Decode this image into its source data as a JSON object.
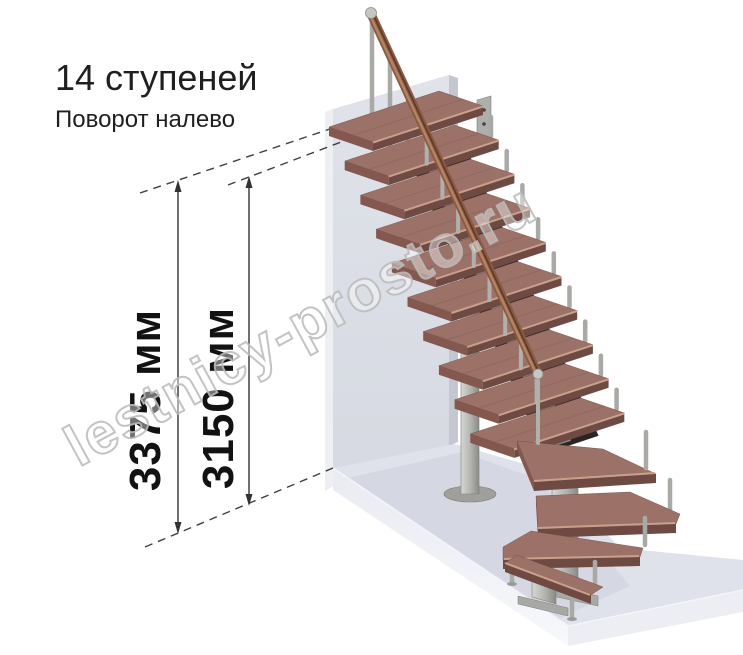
{
  "header": {
    "title": "14 ступеней",
    "subtitle": "Поворот налево"
  },
  "dimensions": {
    "outer": {
      "label": "3375 мм"
    },
    "inner": {
      "label": "3150 мм"
    }
  },
  "watermark": {
    "text": "lestnicy-prosto.ru"
  },
  "staircase": {
    "steps_count": "14",
    "turn_direction": "налево",
    "straight_treads": 10,
    "winder_treads": 3,
    "bottom_treads": 1
  },
  "colors": {
    "text": "#1f1f1f",
    "wood_top": "#9c7167",
    "wood_front": "#6e4a43",
    "metal": "#b3b4b0",
    "wall": "#dcdfe7",
    "floor": "#e0e3ea",
    "dimension_line": "#333333"
  }
}
